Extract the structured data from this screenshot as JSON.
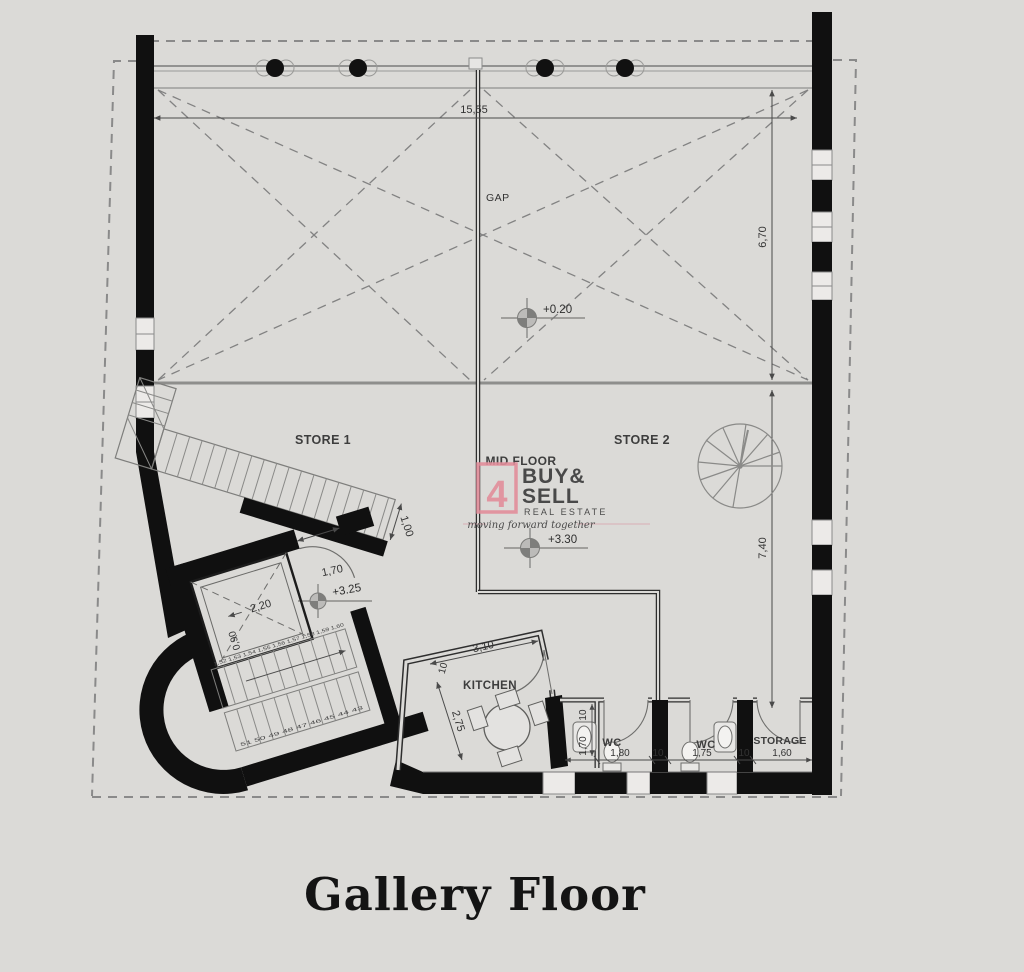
{
  "page": {
    "title": "Gallery Floor"
  },
  "watermark": {
    "number": "4",
    "buy": "BUY&",
    "sell": "SELL",
    "subtitle": "REAL ESTATE",
    "tagline": "moving forward together",
    "accent": "#e28e9b",
    "muted": "#b7b4b2"
  },
  "rooms": {
    "store1": "STORE 1",
    "store2": "STORE 2",
    "midfloor": "MID FLOOR",
    "kitchen": "KITCHEN",
    "wc1": "WC",
    "wc2": "WC",
    "storage": "STORAGE",
    "gap": "GAP"
  },
  "levels": {
    "ground": "+0.20",
    "mid": "+3.30",
    "landing": "+3.25"
  },
  "dimensions": {
    "total_width": "15,55",
    "void_depth": "6,70",
    "hall_depth": "7,40",
    "stair_width": "1,00",
    "elevator_width": "2,20",
    "elevator_depth": "0,90",
    "lobby_door": "1,70",
    "kitchen_width": "3,10",
    "kitchen_depth": "2,75",
    "wall_thickness": "10",
    "wc1_width": "1,80",
    "wc1_depth": "1,70",
    "wc2_width": "1,75",
    "storage_width": "1,60"
  },
  "stairs": {
    "upper_treads": "1,52 1,53 1,54 1,55 1,56 1,57 1,58 1,59 1,60",
    "lower_treads": "51 50 49 48 47 46 45 44 43"
  }
}
